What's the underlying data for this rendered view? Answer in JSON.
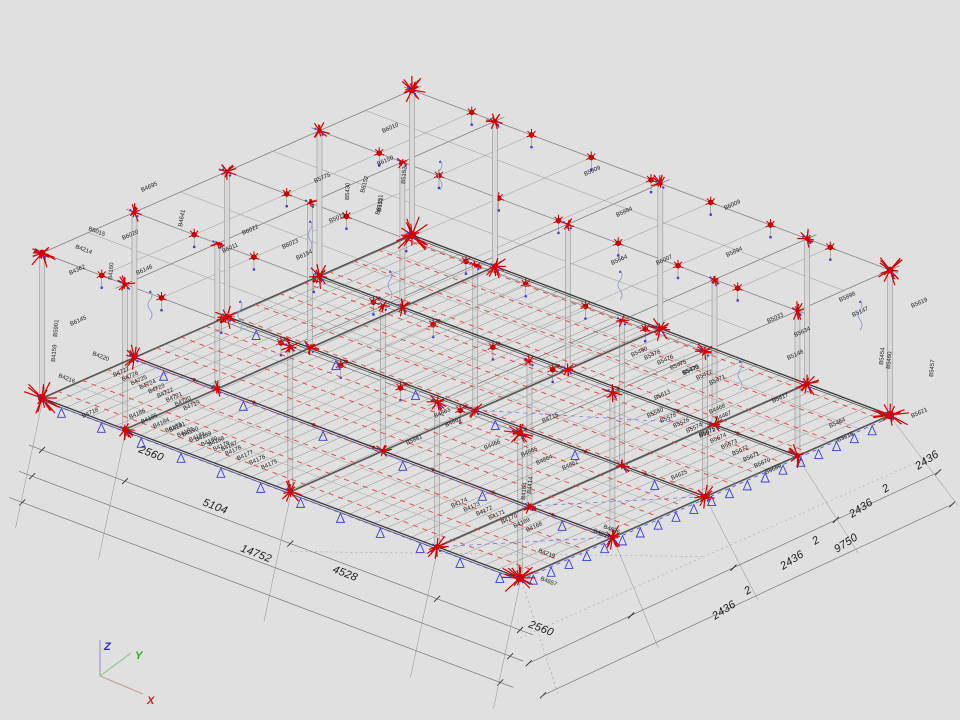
{
  "viewport": {
    "background": "#e0e0e0"
  },
  "axis_triad": {
    "x": {
      "label": "X",
      "color": "#cc2020",
      "line": "#c8a0a0"
    },
    "y": {
      "label": "Y",
      "color": "#1fae1f",
      "line": "#9cc49c"
    },
    "z": {
      "label": "Z",
      "color": "#2828c8",
      "line": "#9aa0c8"
    }
  },
  "colors": {
    "marker_red": "#d40000",
    "dash_red": "#e04545",
    "support_blue": "#3c3cd8",
    "dash_blue": "#5252d8",
    "grid_gray": "#808080",
    "girder_dark": "#3a3a3a"
  },
  "dimensions": {
    "bottom_texts": [
      {
        "text": "2560",
        "x": 138,
        "y": 452,
        "rot": 21
      },
      {
        "text": "5104",
        "x": 202,
        "y": 505,
        "rot": 21
      },
      {
        "text": "14752",
        "x": 240,
        "y": 551,
        "rot": 21
      },
      {
        "text": "4528",
        "x": 332,
        "y": 572,
        "rot": 21
      },
      {
        "text": "2560",
        "x": 528,
        "y": 627,
        "rot": 21
      }
    ],
    "right_texts": [
      {
        "text": "2436",
        "x": 715,
        "y": 620,
        "rot": -33
      },
      {
        "text": "2",
        "x": 747,
        "y": 595,
        "rot": -33
      },
      {
        "text": "2436",
        "x": 783,
        "y": 570,
        "rot": -33
      },
      {
        "text": "2",
        "x": 815,
        "y": 545,
        "rot": -33
      },
      {
        "text": "9750",
        "x": 837,
        "y": 553,
        "rot": -33
      },
      {
        "text": "2436",
        "x": 852,
        "y": 518,
        "rot": -33
      },
      {
        "text": "2",
        "x": 885,
        "y": 493,
        "rot": -33
      },
      {
        "text": "2436",
        "x": 918,
        "y": 470,
        "rot": -33
      }
    ],
    "x_chain_mm": [
      0,
      2560,
      7664,
      12192,
      14752
    ],
    "y_chain_mm": [
      0,
      2436,
      2438,
      4874,
      4876,
      7312,
      7314,
      9750
    ]
  },
  "label_bands": [
    {
      "labels": [
        "B4727",
        "B4726",
        "B4725",
        "B4724",
        "B4723",
        "B4722",
        "B4721",
        "B4720",
        "B4719"
      ],
      "x": 114,
      "y": 377,
      "dx": 8.8,
      "dy": 4.2,
      "rot": -24
    },
    {
      "labels": [
        "B4186",
        "B4185",
        "B4184",
        "B4183",
        "B4182",
        "B4181",
        "B4180",
        "B4179",
        "B4178",
        "B4177",
        "B4176",
        "B4175"
      ],
      "x": 130,
      "y": 419,
      "dx": 12,
      "dy": 4.6,
      "rot": -24
    },
    {
      "labels": [
        "B4174",
        "B4173",
        "B4172",
        "B4171",
        "B4170",
        "B4169",
        "B4168"
      ],
      "x": 452,
      "y": 508,
      "dx": 12.5,
      "dy": 4.0,
      "rot": -24
    },
    {
      "labels": [
        "B4191",
        "B4190",
        "B4189",
        "B4188",
        "B4187"
      ],
      "x": 170,
      "y": 432,
      "dx": 13,
      "dy": 4.8,
      "rot": -24
    },
    {
      "labels": [
        "B5580",
        "B5578",
        "B5576",
        "B5574",
        "B5572"
      ],
      "x": 648,
      "y": 418,
      "dx": 13,
      "dy": 5,
      "rot": -24
    },
    {
      "labels": [
        "B5478",
        "B5476",
        "B5475",
        "B5473",
        "B5472",
        "B5471"
      ],
      "x": 645,
      "y": 360,
      "dx": 13,
      "dy": 5,
      "rot": -24
    },
    {
      "labels": [
        "B5675",
        "B5674",
        "B5673",
        "B5672",
        "B5671",
        "B5670",
        "B5669"
      ],
      "x": 700,
      "y": 437,
      "dx": 11,
      "dy": 6.2,
      "rot": -24
    }
  ],
  "beam_labels": [
    {
      "t": "B4718",
      "x": 83,
      "y": 418,
      "r": -24
    },
    {
      "t": "B4695",
      "x": 142,
      "y": 192,
      "r": -24
    },
    {
      "t": "B4214",
      "x": 75,
      "y": 248,
      "r": 21
    },
    {
      "t": "B6015",
      "x": 88,
      "y": 230,
      "r": 21
    },
    {
      "t": "B4641",
      "x": 182,
      "y": 227,
      "r": -80
    },
    {
      "t": "B6020",
      "x": 123,
      "y": 240,
      "r": -24
    },
    {
      "t": "B6022",
      "x": 243,
      "y": 235,
      "r": -24
    },
    {
      "t": "B6023",
      "x": 283,
      "y": 249,
      "r": -24
    },
    {
      "t": "B6154",
      "x": 297,
      "y": 260,
      "r": -24
    },
    {
      "t": "B4362",
      "x": 70,
      "y": 275,
      "r": -24
    },
    {
      "t": "B6146",
      "x": 137,
      "y": 275,
      "r": -24
    },
    {
      "t": "B6145",
      "x": 71,
      "y": 326,
      "r": -24
    },
    {
      "t": "B5901",
      "x": 57,
      "y": 337,
      "r": -85
    },
    {
      "t": "B4159",
      "x": 55,
      "y": 362,
      "r": -85
    },
    {
      "t": "B4160",
      "x": 112,
      "y": 280,
      "r": -85
    },
    {
      "t": "B4216",
      "x": 58,
      "y": 377,
      "r": 21
    },
    {
      "t": "B4220",
      "x": 92,
      "y": 355,
      "r": 21
    },
    {
      "t": "B6011",
      "x": 223,
      "y": 253,
      "r": -24
    },
    {
      "t": "B6010",
      "x": 383,
      "y": 133,
      "r": -24
    },
    {
      "t": "B6150",
      "x": 378,
      "y": 166,
      "r": -24
    },
    {
      "t": "B5775",
      "x": 315,
      "y": 183,
      "r": -24
    },
    {
      "t": "B6152",
      "x": 364,
      "y": 193,
      "r": -75
    },
    {
      "t": "B6151",
      "x": 379,
      "y": 215,
      "r": -75
    },
    {
      "t": "B5430",
      "x": 349,
      "y": 200,
      "r": -88
    },
    {
      "t": "B5013",
      "x": 330,
      "y": 223,
      "r": -24
    },
    {
      "t": "B5152",
      "x": 405,
      "y": 184,
      "r": -85
    },
    {
      "t": "B5151",
      "x": 381,
      "y": 212,
      "r": -85
    },
    {
      "t": "B5884",
      "x": 617,
      "y": 217,
      "r": -24
    },
    {
      "t": "B5009",
      "x": 585,
      "y": 176,
      "r": -24
    },
    {
      "t": "B6009",
      "x": 725,
      "y": 210,
      "r": -24
    },
    {
      "t": "B5894",
      "x": 727,
      "y": 257,
      "r": -24
    },
    {
      "t": "B5864",
      "x": 612,
      "y": 265,
      "r": -24
    },
    {
      "t": "B6007",
      "x": 657,
      "y": 265,
      "r": -24
    },
    {
      "t": "B5898",
      "x": 840,
      "y": 302,
      "r": -24
    },
    {
      "t": "B5619",
      "x": 912,
      "y": 308,
      "r": -24
    },
    {
      "t": "B5147",
      "x": 853,
      "y": 317,
      "r": -24
    },
    {
      "t": "B5033",
      "x": 768,
      "y": 323,
      "r": -24
    },
    {
      "t": "B5634",
      "x": 795,
      "y": 337,
      "r": -24
    },
    {
      "t": "B5148",
      "x": 788,
      "y": 360,
      "r": -24
    },
    {
      "t": "B5454",
      "x": 883,
      "y": 365,
      "r": -85
    },
    {
      "t": "B5460",
      "x": 890,
      "y": 369,
      "r": -85
    },
    {
      "t": "B5457",
      "x": 933,
      "y": 377,
      "r": -85
    },
    {
      "t": "B5621",
      "x": 912,
      "y": 418,
      "r": -24
    },
    {
      "t": "B5464",
      "x": 830,
      "y": 428,
      "r": -24
    },
    {
      "t": "B5515",
      "x": 838,
      "y": 442,
      "r": -24
    },
    {
      "t": "B5490",
      "x": 632,
      "y": 357,
      "r": -24
    },
    {
      "t": "B5436",
      "x": 683,
      "y": 375,
      "r": -24
    },
    {
      "t": "B5613",
      "x": 655,
      "y": 400,
      "r": -24
    },
    {
      "t": "B4468",
      "x": 710,
      "y": 414,
      "r": -24
    },
    {
      "t": "B4467",
      "x": 716,
      "y": 421,
      "r": -24
    },
    {
      "t": "B5417",
      "x": 773,
      "y": 403,
      "r": -24
    },
    {
      "t": "B4625",
      "x": 672,
      "y": 480,
      "r": -24
    },
    {
      "t": "B4863",
      "x": 435,
      "y": 418,
      "r": -24
    },
    {
      "t": "B4861",
      "x": 446,
      "y": 427,
      "r": -24
    },
    {
      "t": "B4865",
      "x": 522,
      "y": 457,
      "r": -24
    },
    {
      "t": "B4864",
      "x": 537,
      "y": 465,
      "r": -24
    },
    {
      "t": "B4715",
      "x": 543,
      "y": 423,
      "r": -24
    },
    {
      "t": "B4652",
      "x": 563,
      "y": 470,
      "r": -24
    },
    {
      "t": "B5881",
      "x": 407,
      "y": 445,
      "r": -24
    },
    {
      "t": "B4466",
      "x": 485,
      "y": 450,
      "r": -24
    },
    {
      "t": "B4219",
      "x": 538,
      "y": 552,
      "r": 21
    },
    {
      "t": "B4657",
      "x": 540,
      "y": 580,
      "r": 21
    },
    {
      "t": "B4654",
      "x": 593,
      "y": 532,
      "r": 21
    },
    {
      "t": "B4636",
      "x": 603,
      "y": 528,
      "r": 21
    },
    {
      "t": "B4164",
      "x": 525,
      "y": 500,
      "r": -85
    },
    {
      "t": "B4414",
      "x": 531,
      "y": 494,
      "r": -85
    }
  ]
}
